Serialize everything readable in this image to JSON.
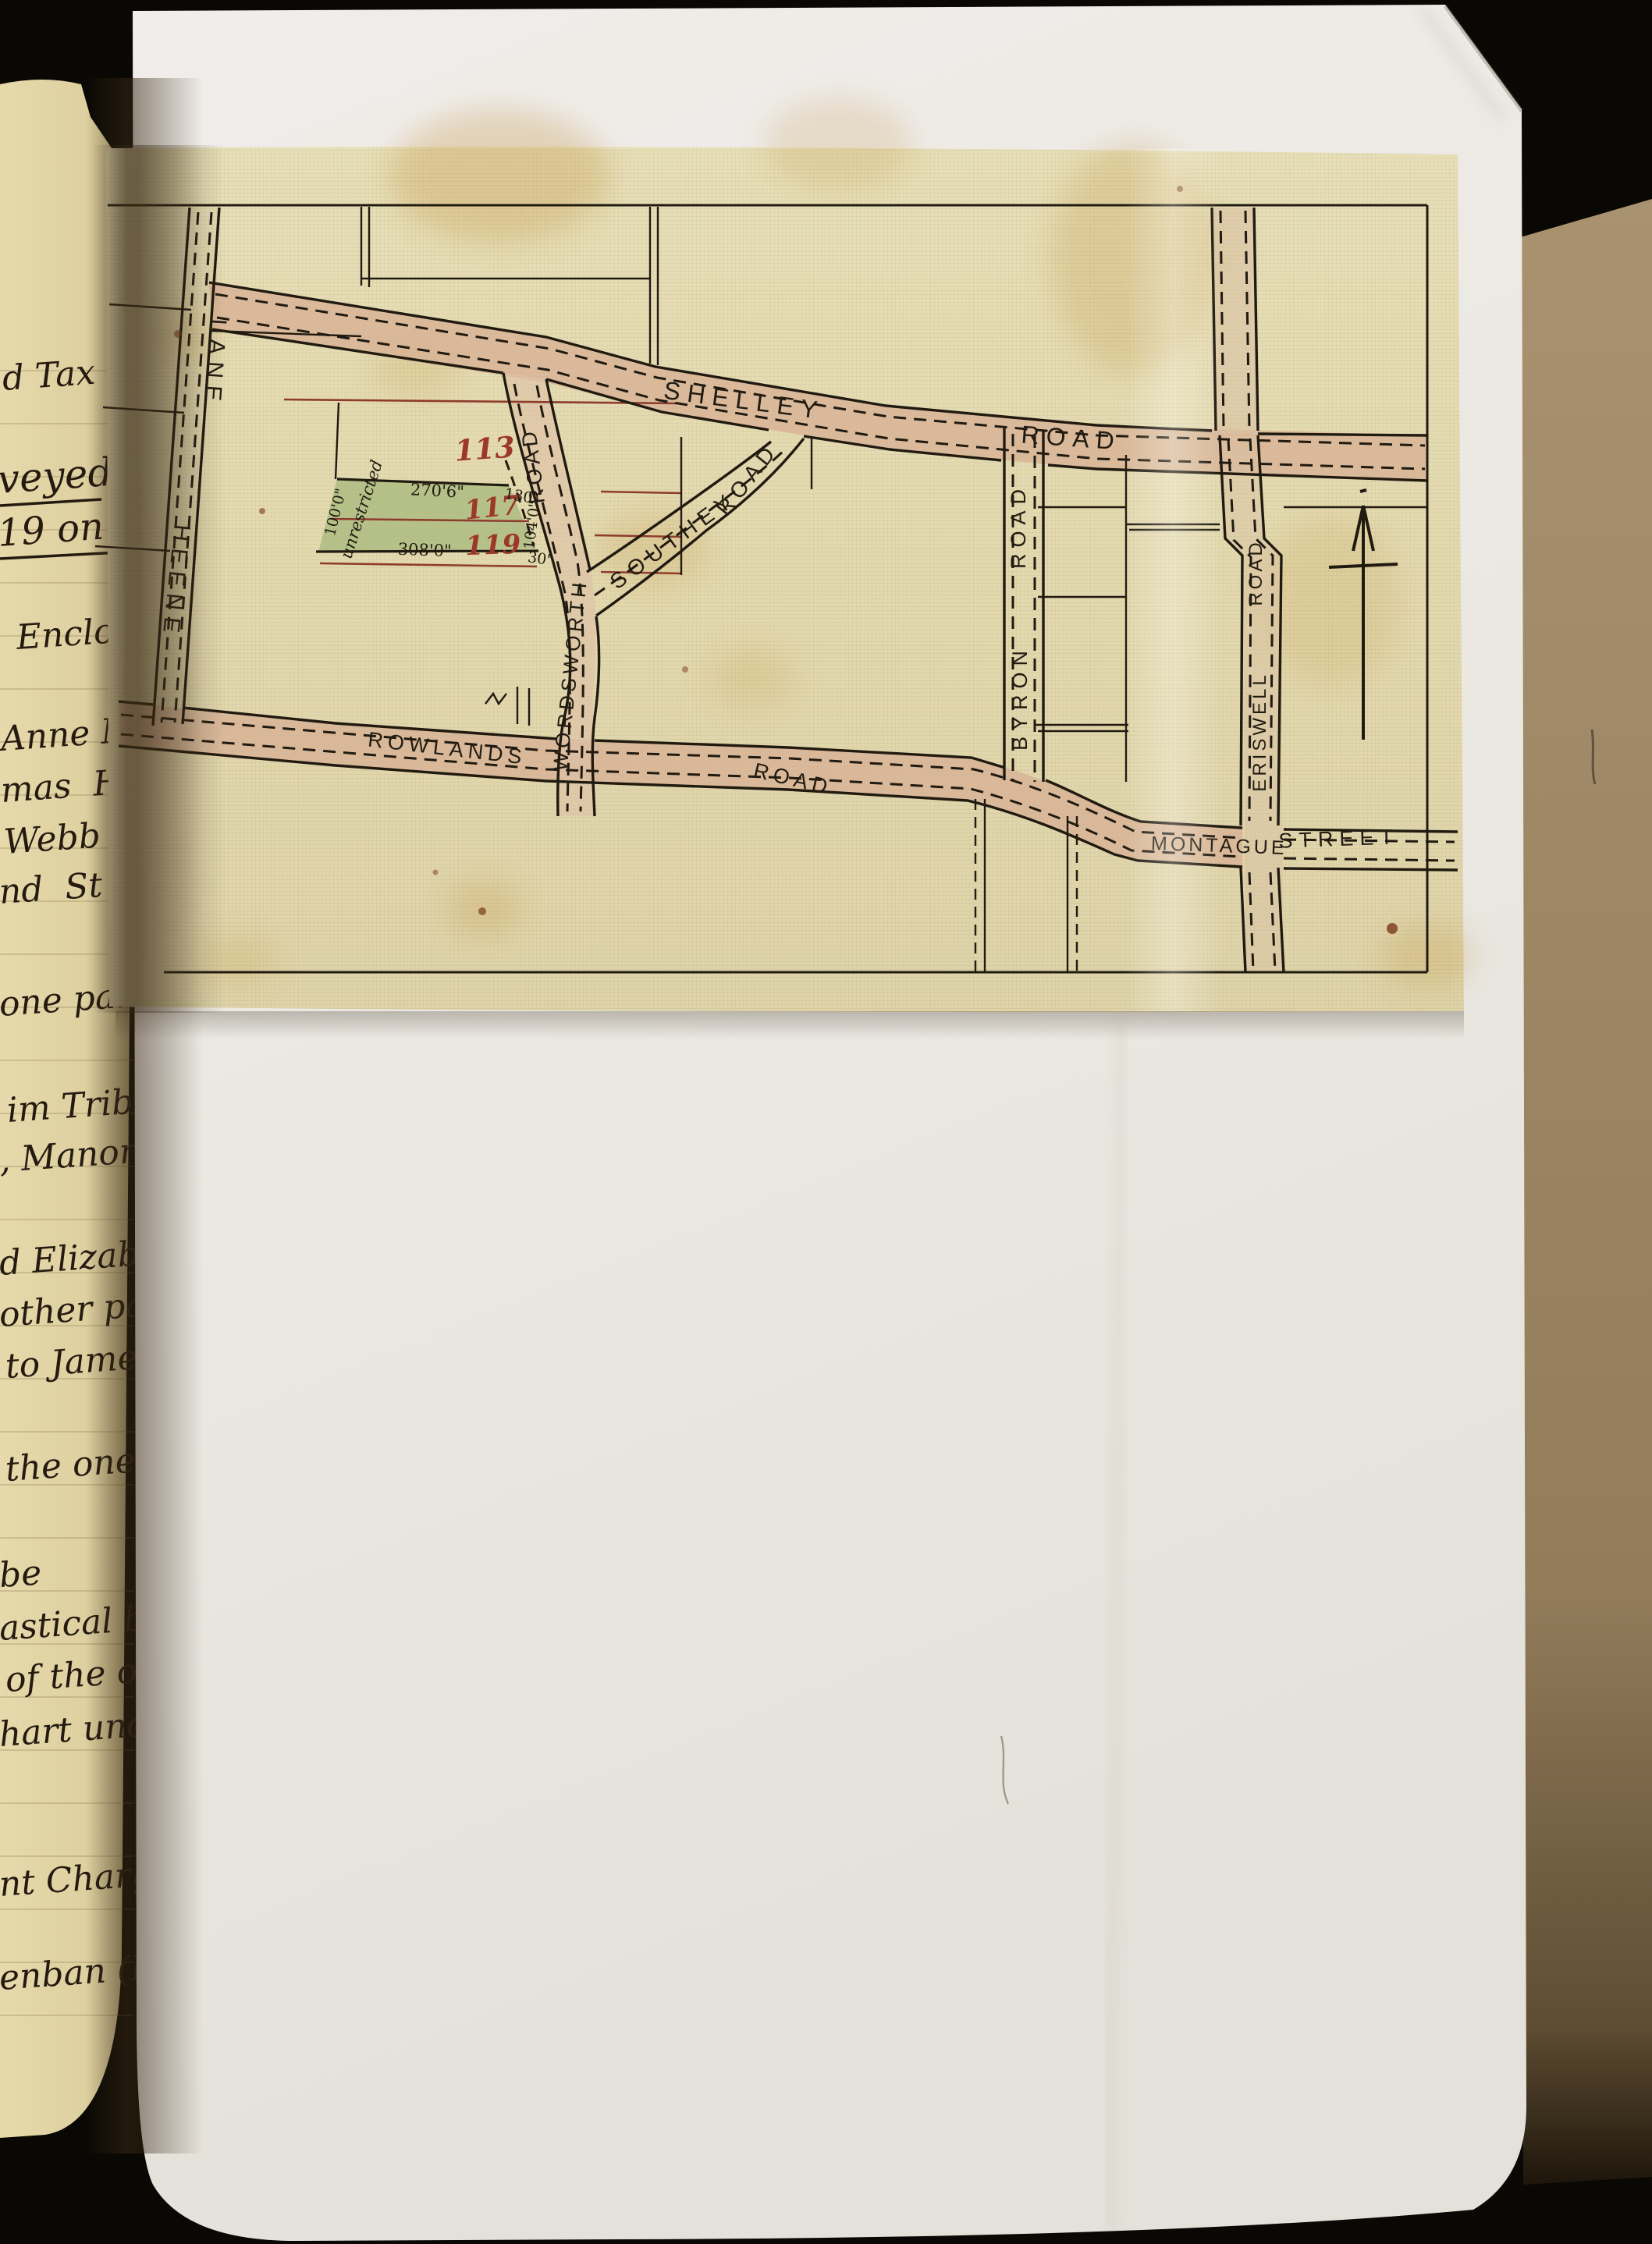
{
  "document_type": "archival deed page with surveyor's street plan on tracing cloth",
  "colors": {
    "background_black": "#0a0804",
    "cardboard": "#a18b6a",
    "ledger_paper": "#e0d2a4",
    "white_paper": "#ebe8e2",
    "tracing_cloth": "#e3dab3",
    "road_pink": "#d7b295",
    "plot_green": "#a9ba80",
    "ink_black": "#201a10",
    "ink_red": "#9c382a",
    "stain_yellow": "#c08f3b"
  },
  "map": {
    "roads": {
      "heene": {
        "name": "HEENE",
        "suffix": "LANE"
      },
      "shelley": {
        "name": "SHELLEY",
        "suffix": "ROAD"
      },
      "wordsworth": {
        "name": "WORDSWORTH",
        "suffix": "ROAD"
      },
      "southey": {
        "name": "SOUTHEY",
        "suffix": "ROAD"
      },
      "rowlands": {
        "name": "ROWLANDS",
        "suffix": "ROAD"
      },
      "byron": {
        "name": "BYRON",
        "suffix": "ROAD"
      },
      "eriswell": {
        "name": "ERISWELL",
        "suffix": "ROAD"
      },
      "montague": {
        "name": "MONTAGUE",
        "suffix": "STREET"
      }
    },
    "plots": {
      "n113": "113",
      "n117": "117",
      "n119": "119",
      "note": "unrestricted"
    },
    "dimensions": {
      "top": "270'6\"",
      "bottom": "308'0\"",
      "left": "100'0\"",
      "right": "104'0\"",
      "tick_top": "130'",
      "tick_bottom": "30'"
    }
  },
  "ledger": {
    "lines": [
      {
        "text": "d Tax"
      },
      {
        "text": "veyed"
      },
      {
        "text": "19 on t"
      },
      {
        "text": "Enclosu"
      },
      {
        "text": "Anne M"
      },
      {
        "text": "mas  H"
      },
      {
        "text": "Webb of"
      },
      {
        "text": "nd  St"
      },
      {
        "text": "one part"
      },
      {
        "text": "im Trib"
      },
      {
        "text": ", Manor"
      },
      {
        "text": "d Elizab"
      },
      {
        "text": "other pa"
      },
      {
        "text": "to James"
      },
      {
        "text": "the one p"
      },
      {
        "text": "be"
      },
      {
        "text": "astical b"
      },
      {
        "text": "of the ot"
      },
      {
        "text": "hart und"
      },
      {
        "text": "nt Charge"
      },
      {
        "text": "enban (L.S)"
      }
    ]
  }
}
